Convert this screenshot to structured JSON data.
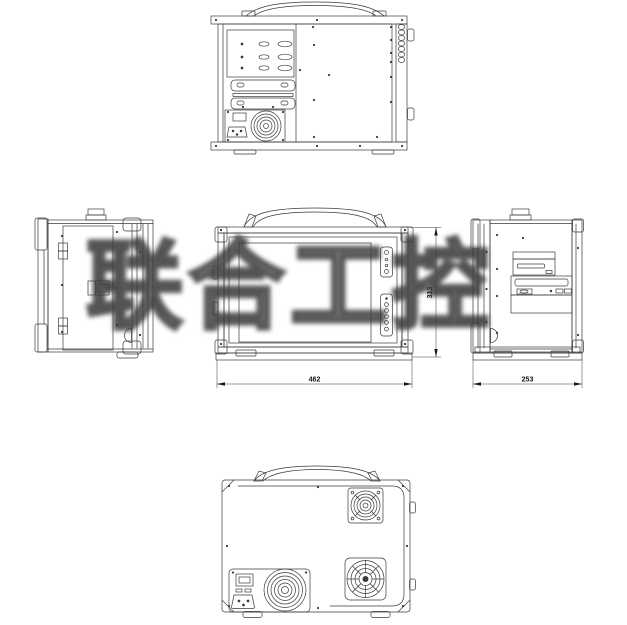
{
  "watermark": {
    "text": "联合工控"
  },
  "dimensions": {
    "front_width": "462",
    "front_height": "313",
    "side_depth": "253"
  },
  "style": {
    "line_color": "#3b3b3b",
    "background": "#ffffff",
    "dimension_text_color": "#111111",
    "watermark_color": "#3a3a3a"
  }
}
